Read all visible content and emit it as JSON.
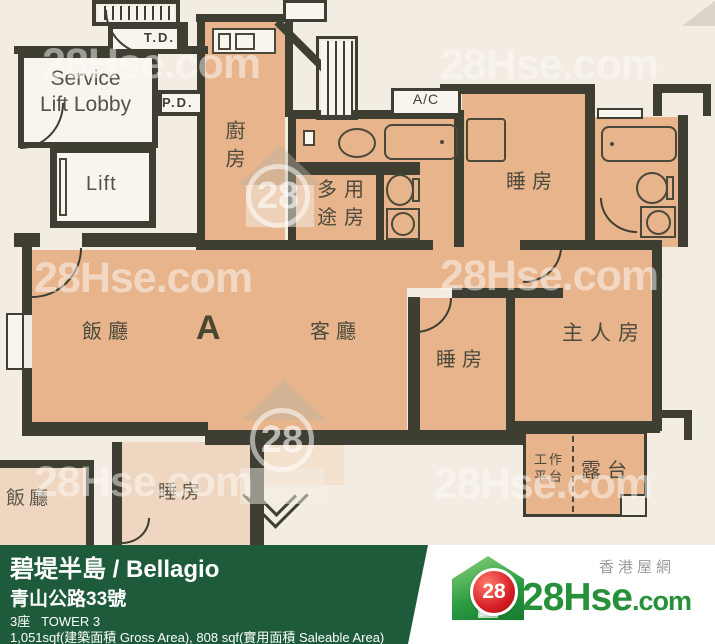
{
  "colors": {
    "wall": "#3e3e32",
    "room_fill": "#e7b48c",
    "room_fill_pale": "#eed6c0",
    "background": "#f2ece3",
    "footer_green": "#1e5b3a",
    "brand_green": "#27903a",
    "brand_red": "#d61c24",
    "label": "#4c4a3c"
  },
  "plan": {
    "unit": "A",
    "labels": {
      "service_lobby_1": "Service",
      "service_lobby_2": "Lift Lobby",
      "lift": "Lift",
      "td": "T.D.",
      "pd": "P.D.",
      "ac": "A/C",
      "kitchen": "廚房",
      "multi_1": "多用",
      "multi_2": "途房",
      "bedroom_top": "睡房",
      "dining": "飯廳",
      "living": "客廳",
      "bedroom_mid": "睡房",
      "master": "主人房",
      "work_1": "工作",
      "work_2": "平台",
      "balcony": "露台",
      "lower_dining": "飯廳",
      "lower_bedroom": "睡房"
    },
    "watermark": {
      "text": "28Hse.com",
      "badge": "28"
    }
  },
  "footer": {
    "title": "碧堤半島 / Bellagio",
    "address": "青山公路33號",
    "tower": "3座   TOWER 3",
    "area": "1,051sqf(建築面積 Gross Area), 808 sqf(實用面積 Saleable Area)",
    "logo": {
      "badge": "28",
      "brand": "28Hse",
      "brand_suffix": ".com",
      "tagline": "香港屋網"
    }
  }
}
